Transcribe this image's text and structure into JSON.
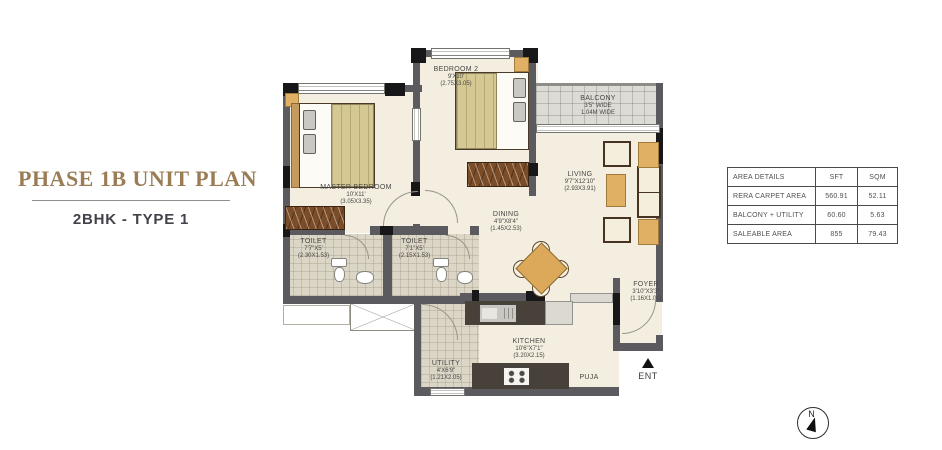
{
  "header": {
    "title": "PHASE 1B UNIT PLAN",
    "subtitle": "2BHK - TYPE 1"
  },
  "rooms": {
    "master_bedroom": {
      "name": "MASTER BEDROOM",
      "dim": "10'X11'",
      "dim_m": "(3.05X3.35)"
    },
    "bedroom2": {
      "name": "BEDROOM 2",
      "dim": "9'X10'",
      "dim_m": "(2.75X3.05)"
    },
    "balcony": {
      "name": "BALCONY",
      "dim": "3'5\" WIDE",
      "dim_m": "1.04M WIDE"
    },
    "living": {
      "name": "LIVING",
      "dim": "9'7\"X12'10\"",
      "dim_m": "(2.93X3.91)"
    },
    "dining": {
      "name": "DINING",
      "dim": "4'9\"X8'4\"",
      "dim_m": "(1.45X2.53)"
    },
    "toilet_1": {
      "name": "TOILET",
      "dim": "7'7\"X5'",
      "dim_m": "(2.30X1.53)"
    },
    "toilet_2": {
      "name": "TOILET",
      "dim": "7'1\"X5'",
      "dim_m": "(2.15X1.53)"
    },
    "foyer": {
      "name": "FOYER",
      "dim": "3'10\"X3'3\"",
      "dim_m": "(1.16X1.00)"
    },
    "kitchen": {
      "name": "KITCHEN",
      "dim": "10'6\"X7'1\"",
      "dim_m": "(3.20X2.15)"
    },
    "utility": {
      "name": "UTILITY",
      "dim": "4'X6'9\"",
      "dim_m": "(1.21X2.05)"
    },
    "puja": {
      "name": "PUJA"
    }
  },
  "entry": {
    "label": "ENT"
  },
  "compass": {
    "north": "N"
  },
  "area_table": {
    "headers": [
      "AREA DETAILS",
      "SFT",
      "SQM"
    ],
    "rows": [
      [
        "RERA CARPET AREA",
        "560.91",
        "52.11"
      ],
      [
        "BALCONY + UTILITY",
        "60.60",
        "5.63"
      ],
      [
        "SALEABLE AREA",
        "855",
        "79.43"
      ]
    ]
  },
  "colors": {
    "title": "#9a7c55",
    "subtitle": "#43424b",
    "wall": "#5b5a5f",
    "floor": "#f3eedf",
    "tile": "#dcd6c7",
    "accent_wood": "#dca95a"
  }
}
